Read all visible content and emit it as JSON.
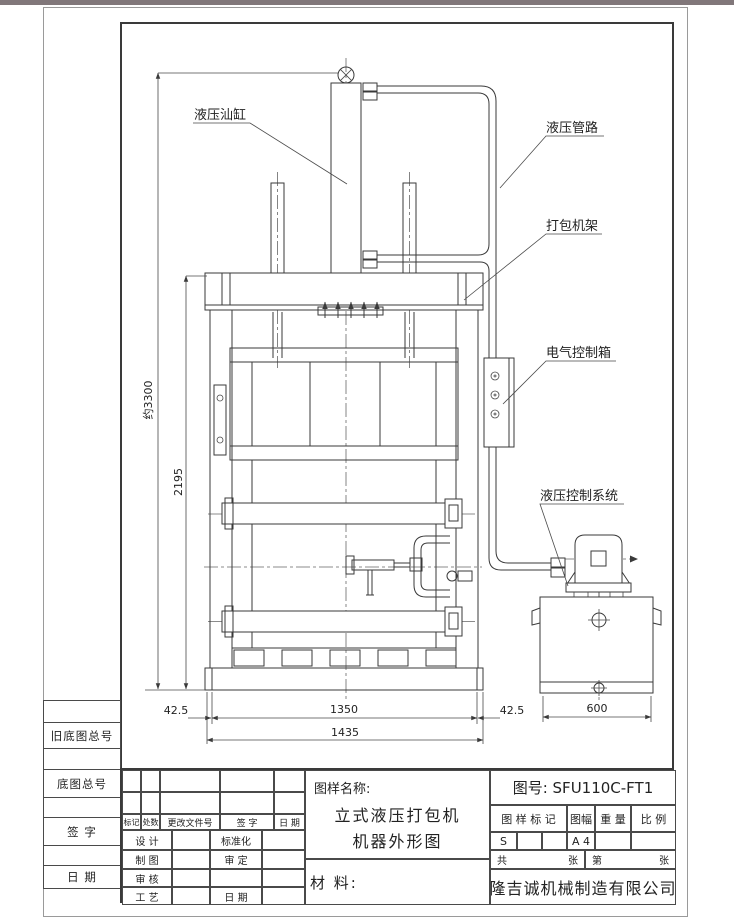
{
  "drawing": {
    "callouts": {
      "cylinder": "液压汕缸",
      "piping": "液压管路",
      "frame": "打包机架",
      "electric_box": "电气控制箱",
      "hydraulic_system": "液压控制系统"
    },
    "dims": {
      "overall_height": "约3300",
      "chamber_height": "2195",
      "left_offset": "42.5",
      "bale_width": "1350",
      "right_offset": "42.5",
      "overall_width": "1435",
      "tank_width": "600"
    }
  },
  "margin": {
    "labels": [
      "旧底图总号",
      "底图总号",
      "签  字",
      "日  期"
    ]
  },
  "title_block": {
    "name_label": "图样名称:",
    "name_line1": "立式液压打包机",
    "name_line2": "机器外形图",
    "material_label": "材  料:",
    "drawing_no": "图号: SFU110C-FT1",
    "header": {
      "mark": "图 样 标 记",
      "size": "图幅",
      "weight": "重 量",
      "scale": "比 例"
    },
    "values": {
      "mark": "S",
      "size": "A 4"
    },
    "sheets": {
      "total_label": "共",
      "unit1": "张",
      "no_label": "第",
      "unit2": "张"
    },
    "company": "隆吉诚机械制造有限公司",
    "revision_header": [
      "标记",
      "处数",
      "更改文件号",
      "签  字",
      "日 期"
    ],
    "sign_rows": [
      {
        "left": "设 计",
        "right": "标准化"
      },
      {
        "left": "制 图",
        "right": "审 定"
      },
      {
        "left": "审 核",
        "right": ""
      },
      {
        "left": "工 艺",
        "right": "日 期"
      }
    ]
  }
}
